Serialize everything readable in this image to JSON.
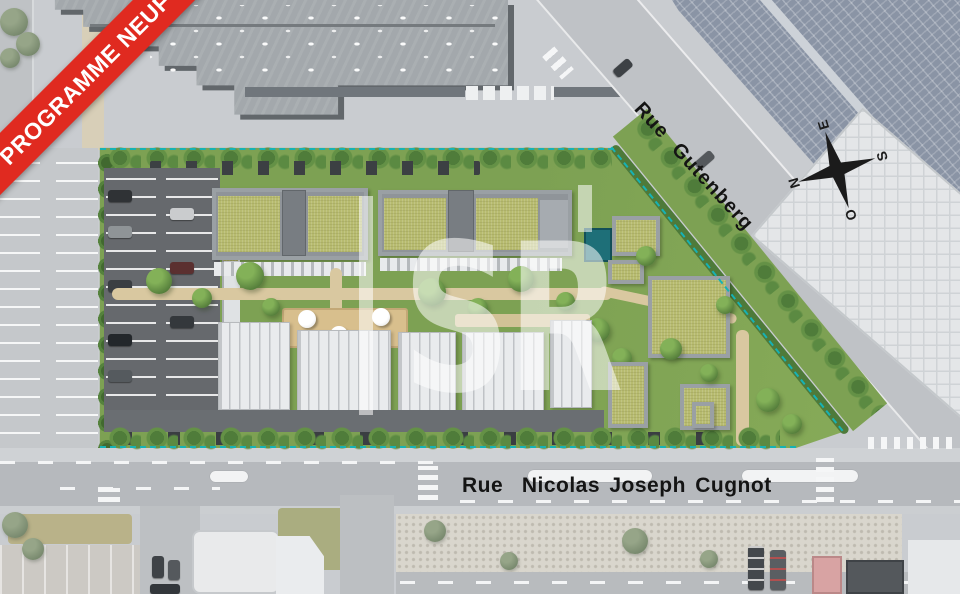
{
  "banner": {
    "label": "PROGRAMME NEUF",
    "bg_color": "#e02a20",
    "text_color": "#ffffff"
  },
  "streets": {
    "gutenberg": {
      "name": "Rue Gutenberg",
      "angle_deg": 47.5
    },
    "cugnot": {
      "name": "Rue  Nicolas Joseph Cugnot"
    }
  },
  "compass": {
    "north": "N",
    "east": "E",
    "south": "S",
    "west": "O",
    "rotation_deg": -107,
    "color": "#1b1b1b"
  },
  "watermark": {
    "text": "SR",
    "color": "rgba(255,255,255,0.55)"
  },
  "site": {
    "boundary_line_color": "#16b2b5",
    "lawn_color": "#7da153",
    "sedum_roof_color": "#b7bb6f",
    "asphalt_color": "#66696d",
    "unit_roof_color": "#e9ebed",
    "teal_cabin_color": "#1e6f78"
  },
  "surroundings": {
    "concrete_color": "#c9ccd0",
    "road_color": "#b6b9bd",
    "industrial_roof_color": "#a3a8ac",
    "solar_roof_color": "#8a94a5",
    "warehouse_color": "#e4e6e8"
  }
}
